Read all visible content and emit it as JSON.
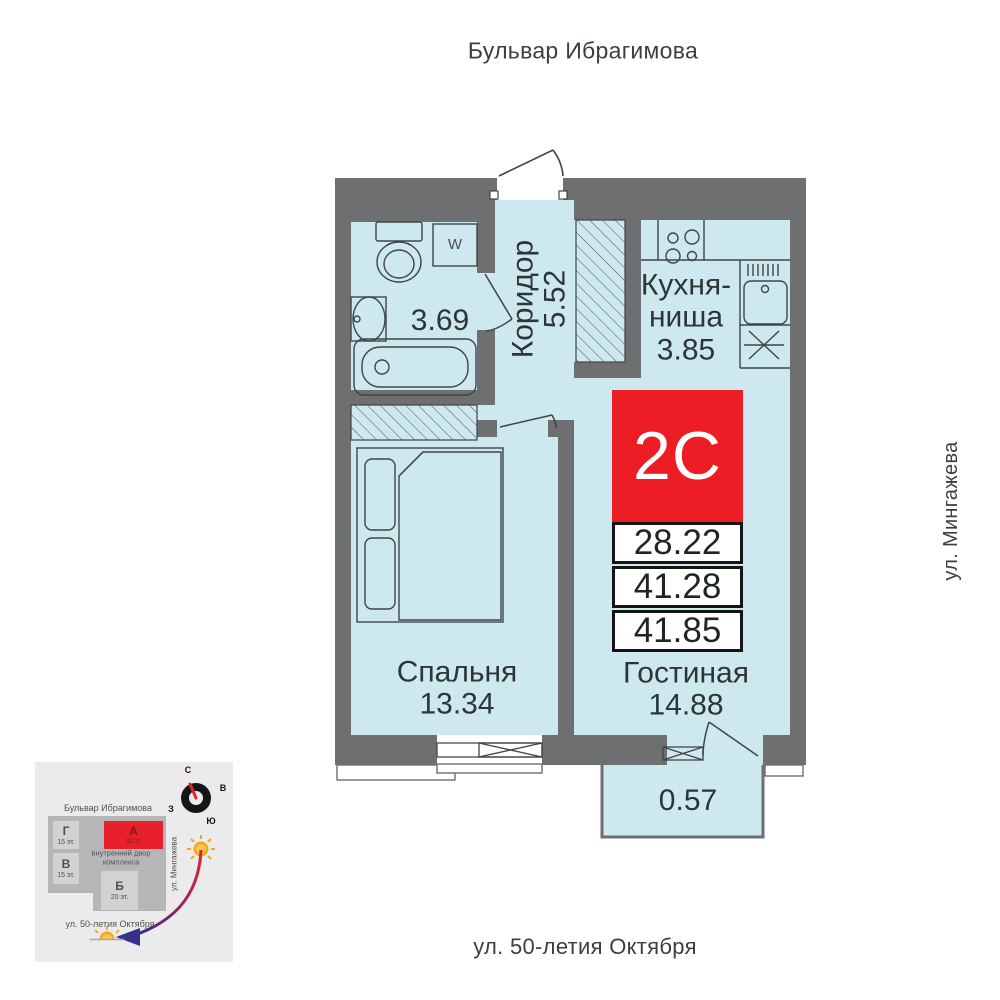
{
  "streets": {
    "top": "Бульвар Ибрагимова",
    "right": "ул. Мингажева",
    "bottom": "ул. 50-летия Октября"
  },
  "unit": {
    "badge": "2С",
    "area_living": "28.22",
    "area_no_balcony": "41.28",
    "area_total": "41.85"
  },
  "rooms": {
    "corridor": {
      "name": "Коридор",
      "area": "5.52"
    },
    "kitchen": {
      "name": "Кухня-ниша",
      "area": "3.85"
    },
    "bathroom": {
      "area": "3.69"
    },
    "bedroom": {
      "name": "Спальня",
      "area": "13.34"
    },
    "living": {
      "name": "Гостиная",
      "area": "14.88"
    },
    "balcony": {
      "area": "0.57"
    },
    "washer_label": "W"
  },
  "minimap": {
    "street_top": "Бульвар Ибрагимова",
    "street_right": "ул. Мингажева",
    "street_bottom": "ул. 50-летия Октября",
    "courtyard": "внутренний двор комплекса",
    "compass": {
      "n": "С",
      "e": "В",
      "w": "З",
      "s": "Ю"
    },
    "buildings": [
      {
        "label": "Г",
        "floors": "15 эт."
      },
      {
        "label": "В",
        "floors": "15 эт."
      },
      {
        "label": "А",
        "floors": "33 эт."
      },
      {
        "label": "Б",
        "floors": "20 эт."
      }
    ]
  },
  "colors": {
    "wall": "#6e6f70",
    "floor": "#cde9ef",
    "accent_red": "#ec1d24",
    "line": "#3f4547"
  }
}
